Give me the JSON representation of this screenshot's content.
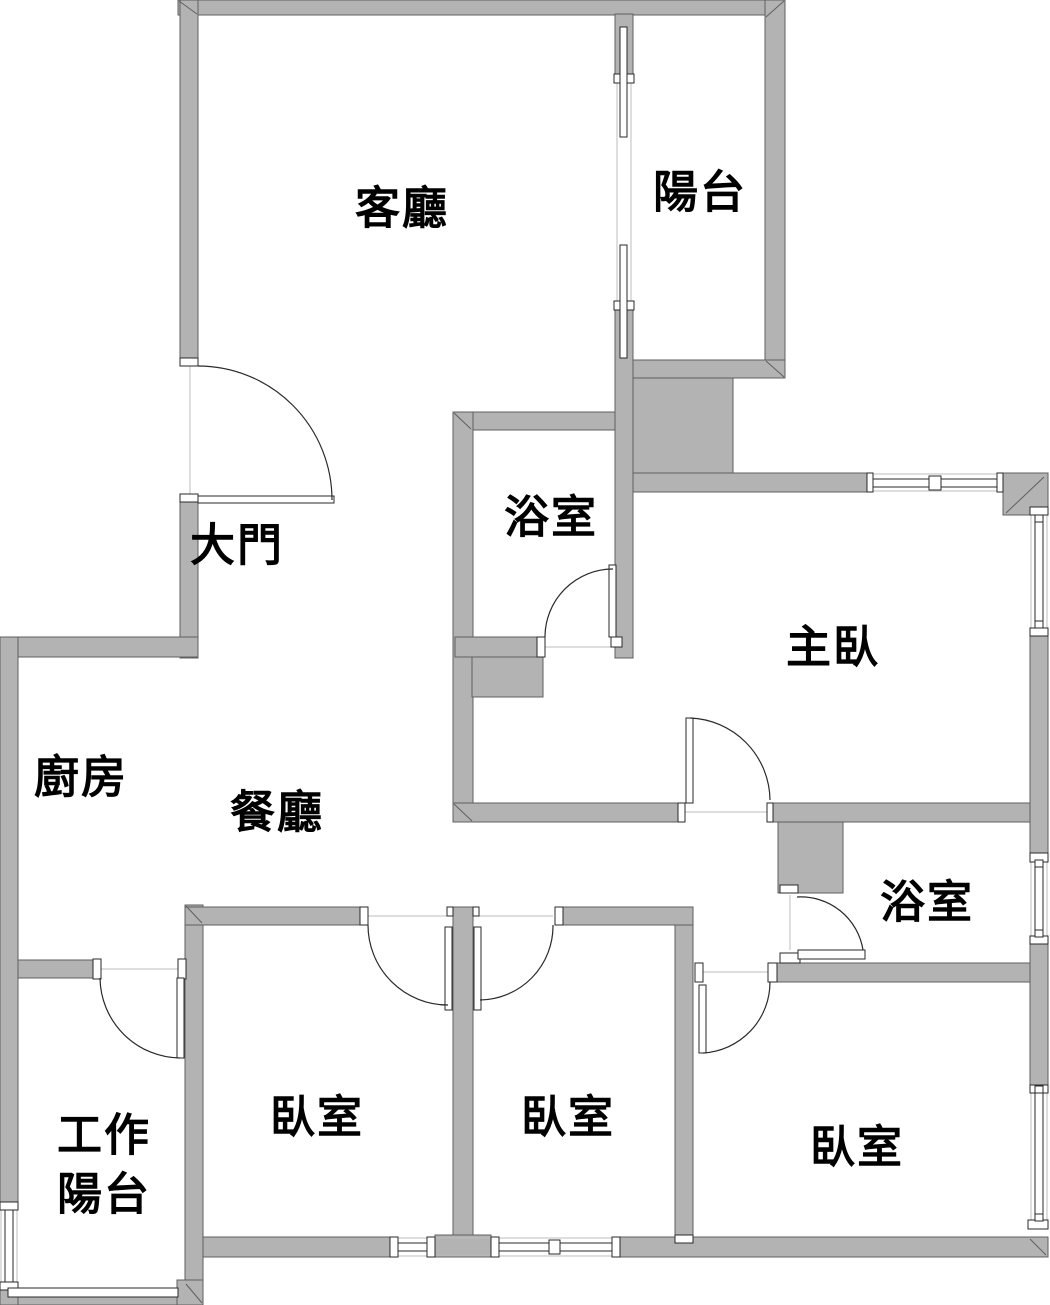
{
  "meta": {
    "type": "apartment-floor-plan",
    "language": "zh-TW"
  },
  "colors": {
    "wall_fill": "#b3b3b3",
    "wall_stroke": "#5f5f5f",
    "background": "#ffffff",
    "text_color": "#000000"
  },
  "labels": {
    "living_room": "客廳",
    "balcony": "陽台",
    "bathroom_main": "浴室",
    "master_bedroom": "主臥",
    "main_entrance": "大門",
    "kitchen": "廚房",
    "dining_room": "餐廳",
    "bathroom_ensuite": "浴室",
    "bedroom_left": "臥室",
    "bedroom_middle": "臥室",
    "bedroom_right": "臥室",
    "work_balcony_line1": "工作",
    "work_balcony_line2": "陽台"
  }
}
